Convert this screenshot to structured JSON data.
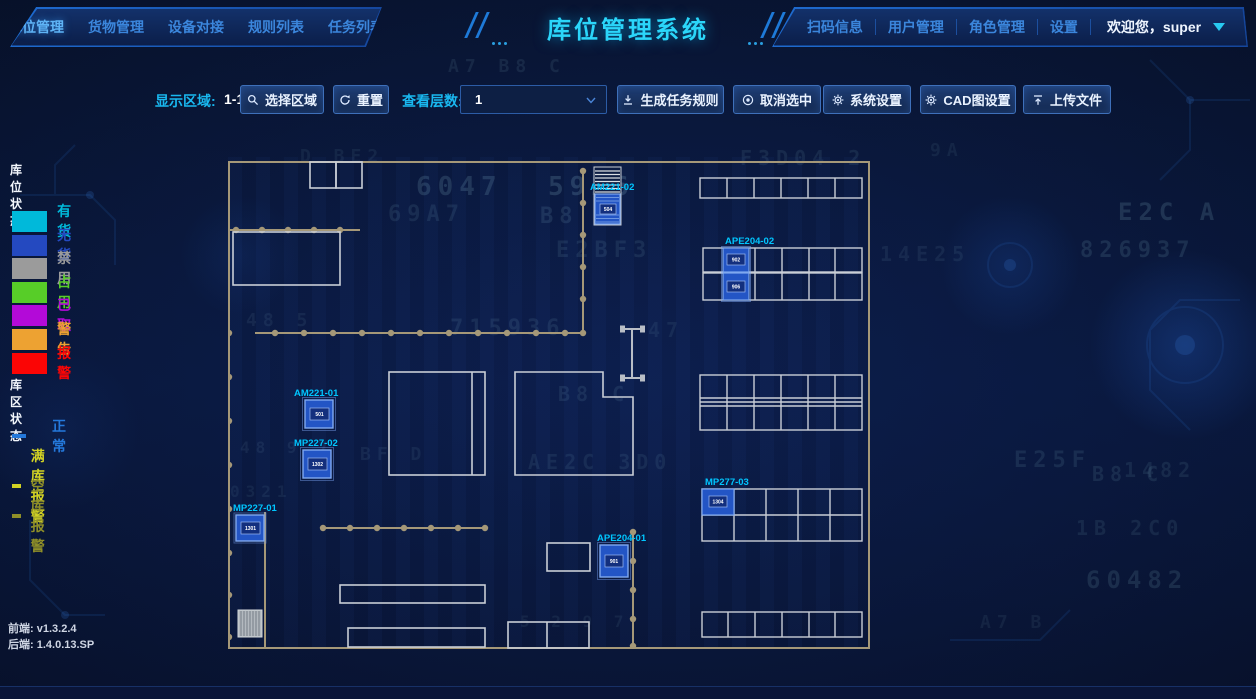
{
  "header": {
    "left_nav": [
      "库位管理",
      "货物管理",
      "设备对接",
      "规则列表",
      "任务列表"
    ],
    "title": "库位管理系统",
    "right_nav": [
      "扫码信息",
      "用户管理",
      "角色管理",
      "设置"
    ],
    "welcome": "欢迎您，super"
  },
  "toolbar": {
    "display_area_label": "显示区域:",
    "display_area_value": "1-1-1",
    "select_area": "选择区域",
    "reset": "重置",
    "layer_label": "查看层数:",
    "layer_value": "1",
    "generate_rule": "生成任务规则",
    "cancel_selected": "取消选中",
    "system_settings": "系统设置",
    "cad_settings": "CAD图设置",
    "upload": "上传文件"
  },
  "legend": {
    "slot_title": "库位状态",
    "slot_items": [
      {
        "label": "有货",
        "color": "#00b9da"
      },
      {
        "label": "无货",
        "color": "#2449c0"
      },
      {
        "label": "禁用",
        "color": "#9b9b9b"
      },
      {
        "label": "占用",
        "color": "#57cd28"
      },
      {
        "label": "已取",
        "color": "#b30ad8"
      },
      {
        "label": "警告",
        "color": "#eda232"
      },
      {
        "label": "报警",
        "color": "#fb0505"
      }
    ],
    "area_title": "库区状态",
    "area_items": [
      {
        "label": "正常",
        "color": "#2478da"
      },
      {
        "label": "满库报警",
        "color": "#d2d224"
      },
      {
        "label": "空库报警",
        "color": "#8f8f28"
      }
    ]
  },
  "versions": {
    "frontend_label": "前端:",
    "frontend_value": "v1.3.2.4",
    "backend_label": "后端:",
    "backend_value": "1.4.0.13.SP"
  },
  "map": {
    "labels": {
      "am221_02": "AM221-02",
      "ape204_02": "APE204-02",
      "am221_01": "AM221-01",
      "mp227_02": "MP227-02",
      "mp227_01": "MP227-01",
      "ape204_01": "APE204-01",
      "mp277_03": "MP277-03"
    },
    "cells": {
      "am221_02": "504",
      "ape204_02_top": "902",
      "ape204_02_bottom": "906",
      "am221_01": "501",
      "mp227_02": "1302",
      "mp227_01": "1301",
      "ape204_01": "901",
      "mp277_03": "1304"
    },
    "accent_label_color": "#00c6ff",
    "slot_fill_color": "#2355c5"
  },
  "background_glyphs": [
    {
      "t": "A7 B8 C",
      "x": 448,
      "y": 56,
      "s": 18,
      "o": 0.09
    },
    {
      "t": "D BE2",
      "x": 300,
      "y": 146,
      "s": 18,
      "o": 0.07
    },
    {
      "t": "F3D04 2",
      "x": 740,
      "y": 146,
      "s": 20,
      "o": 0.09
    },
    {
      "t": "6047",
      "x": 416,
      "y": 172,
      "s": 26,
      "o": 0.16
    },
    {
      "t": "5926",
      "x": 548,
      "y": 172,
      "s": 26,
      "o": 0.18
    },
    {
      "t": "69A7",
      "x": 388,
      "y": 202,
      "s": 22,
      "o": 0.1
    },
    {
      "t": "B8  C",
      "x": 540,
      "y": 204,
      "s": 22,
      "o": 0.12
    },
    {
      "t": "E2C  A",
      "x": 1118,
      "y": 198,
      "s": 24,
      "o": 0.15
    },
    {
      "t": "9A",
      "x": 930,
      "y": 140,
      "s": 18,
      "o": 0.07
    },
    {
      "t": "E2BF3",
      "x": 556,
      "y": 238,
      "s": 22,
      "o": 0.1
    },
    {
      "t": "14E25",
      "x": 880,
      "y": 242,
      "s": 20,
      "o": 0.08
    },
    {
      "t": "826937",
      "x": 1080,
      "y": 238,
      "s": 22,
      "o": 0.12
    },
    {
      "t": "48 5",
      "x": 246,
      "y": 310,
      "s": 18,
      "o": 0.08
    },
    {
      "t": "715936",
      "x": 450,
      "y": 316,
      "s": 22,
      "o": 0.1
    },
    {
      "t": "47",
      "x": 648,
      "y": 318,
      "s": 20,
      "o": 0.08
    },
    {
      "t": "B8  C",
      "x": 558,
      "y": 382,
      "s": 20,
      "o": 0.1
    },
    {
      "t": "BF  D",
      "x": 360,
      "y": 444,
      "s": 18,
      "o": 0.08
    },
    {
      "t": "AE2C 3D0",
      "x": 528,
      "y": 450,
      "s": 20,
      "o": 0.09
    },
    {
      "t": "E25F",
      "x": 1014,
      "y": 448,
      "s": 22,
      "o": 0.1
    },
    {
      "t": "1482",
      "x": 1124,
      "y": 458,
      "s": 20,
      "o": 0.09
    },
    {
      "t": "B8 C",
      "x": 1092,
      "y": 462,
      "s": 20,
      "o": 0.1
    },
    {
      "t": "48 9 7",
      "x": 240,
      "y": 438,
      "s": 16,
      "o": 0.08
    },
    {
      "t": "0321",
      "x": 230,
      "y": 482,
      "s": 16,
      "o": 0.07
    },
    {
      "t": "1B 2C0",
      "x": 1076,
      "y": 516,
      "s": 20,
      "o": 0.09
    },
    {
      "t": "60482",
      "x": 1086,
      "y": 566,
      "s": 24,
      "o": 0.12
    },
    {
      "t": "5 2 9 7",
      "x": 520,
      "y": 612,
      "s": 16,
      "o": 0.08
    },
    {
      "t": "A7  B",
      "x": 980,
      "y": 612,
      "s": 18,
      "o": 0.07
    }
  ]
}
